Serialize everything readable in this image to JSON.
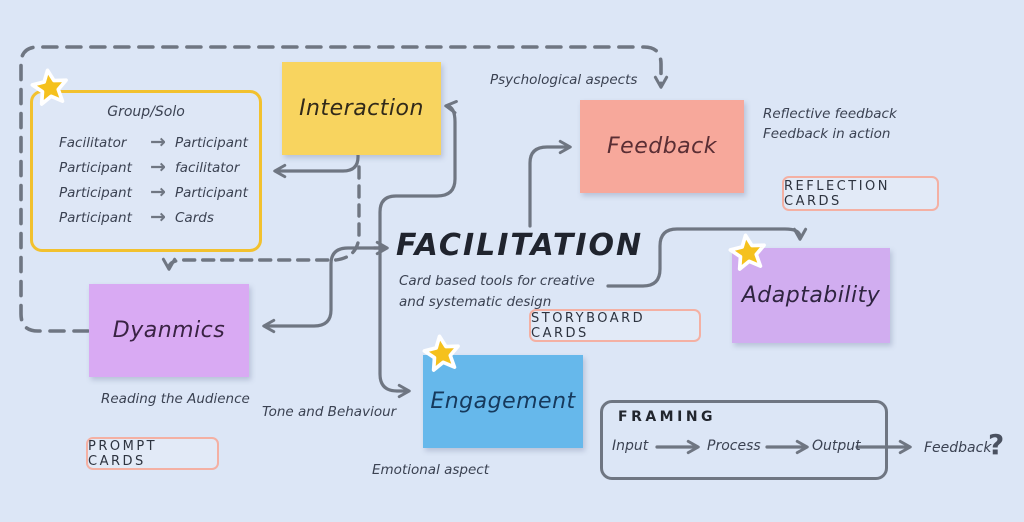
{
  "board": {
    "title": "FACILITATION",
    "subtitle1": "Card based tools for creative",
    "subtitle2": "and systematic design"
  },
  "icons": {
    "arrow_right": "→",
    "question_mark": "?",
    "star": "star"
  },
  "colors": {
    "background": "#dce6f6",
    "line_gray": "#6f7682",
    "interaction_yellow": "#f8d45f",
    "feedback_salmon": "#f7a89b",
    "dynamics_purple": "#d9aaf3",
    "adaptability_purple": "#d1adf0",
    "engagement_blue": "#66b8eb",
    "card_border_pink": "#f4b0a3",
    "star_gold": "#f5c11d",
    "group_frame_yellow": "#f2c12e"
  },
  "boxes": {
    "interaction": {
      "label": "Interaction"
    },
    "feedback": {
      "label": "Feedback"
    },
    "dynamics": {
      "label": "Dyanmics"
    },
    "adaptability": {
      "label": "Adaptability"
    },
    "engagement": {
      "label": "Engagement"
    }
  },
  "group_solo": {
    "title": "Group/Solo",
    "rows": [
      {
        "from": "Facilitator",
        "to": "Participant"
      },
      {
        "from": "Participant",
        "to": "facilitator"
      },
      {
        "from": "Participant",
        "to": "Participant"
      },
      {
        "from": "Participant",
        "to": "Cards"
      }
    ]
  },
  "cards": {
    "reflection": "REFLECTION CARDS",
    "storyboard": "STORYBOARD CARDS",
    "prompt": "PROMPT CARDS"
  },
  "annotations": {
    "psychological": "Psychological aspects",
    "reflective1": "Reflective feedback",
    "reflective2": "Feedback in action",
    "reading": "Reading the Audience",
    "tone": "Tone and Behaviour",
    "emotional": "Emotional aspect"
  },
  "framing": {
    "title": "FRAMING",
    "steps": [
      "Input",
      "Process",
      "Output",
      "Feedback"
    ]
  }
}
